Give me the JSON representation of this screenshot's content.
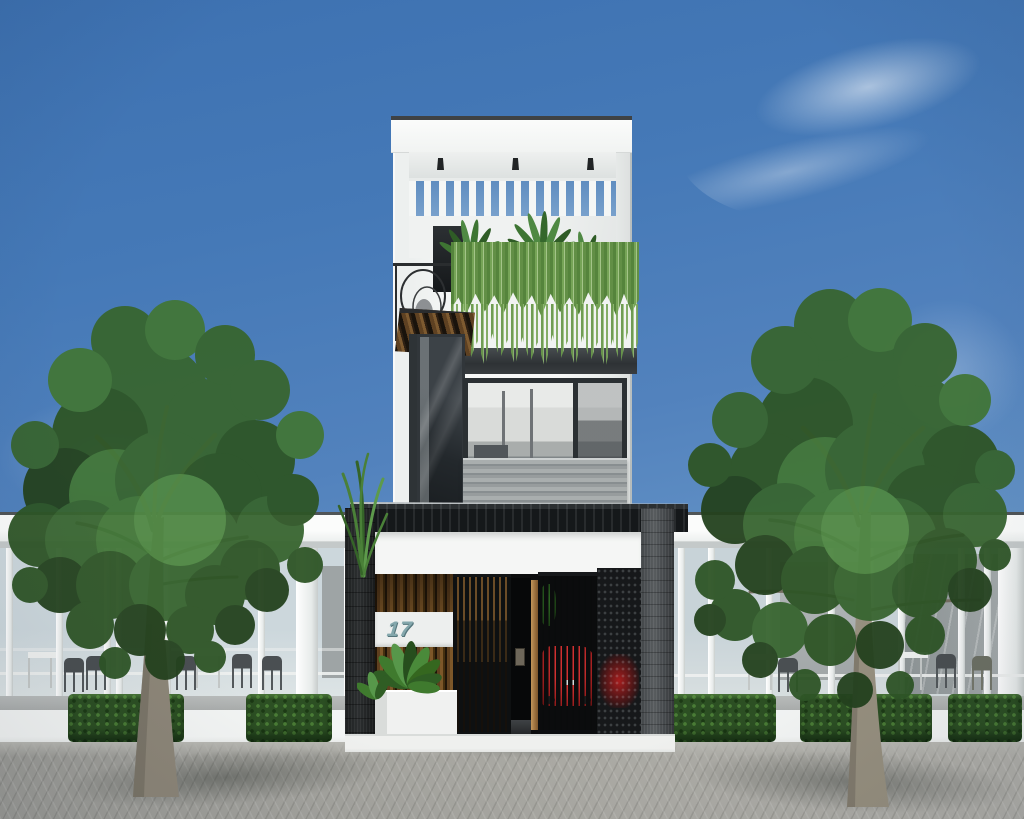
{
  "scene": {
    "setting": "daytime architectural exterior rendering, front elevation",
    "house_number": "17",
    "elements": [
      "three-storey narrow townhouse",
      "rooftop pergola with downlights",
      "hanging vine curtain over balcony planter",
      "wrought-iron spiral decor on terrace",
      "wood louver awning",
      "glass door and picture window with slatted grey parapet",
      "black slatted entry canopy",
      "vertical wood slat wall with number plate",
      "open slatted gates with red car glimpse",
      "perforated metal screen",
      "white entry planters with foliage",
      "two street trees",
      "open white cafe pavilions with chairs and tables",
      "boxwood hedges on low white wall",
      "grey paver plaza"
    ]
  },
  "palette": {
    "sky_top": "#3d71b1",
    "sky_horizon": "#9dbcdd",
    "cloud_white": "#ffffff",
    "facade_white": "#f5f6f5",
    "frame_dark": "#2b3033",
    "canopy_black": "#15181a",
    "wood_brown": "#7d5729",
    "vine_green": "#76a457",
    "tree_green": "#386530",
    "hedge_green": "#2c4f23",
    "parapet_grey": "#979c9d",
    "pavement_grey": "#a5a5a0",
    "car_red": "#c02828",
    "number_teal": "#84a7ac"
  }
}
